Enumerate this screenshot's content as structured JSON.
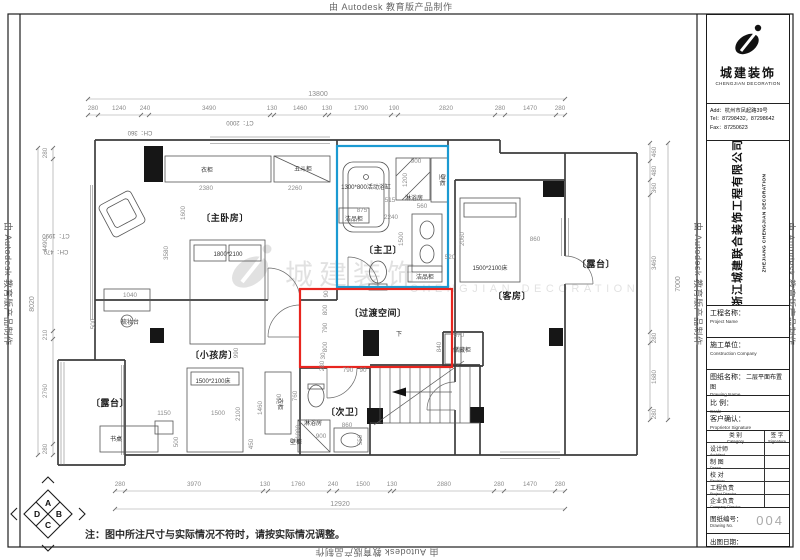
{
  "watermark": {
    "text": "由 Autodesk 教育版产品制作"
  },
  "watermark_center": {
    "cn": "城建装饰",
    "en": "CHENGJIAN DECORATION"
  },
  "note": "注：图中所注尺寸与实际情况不符时，请按实际情况调整。",
  "compass": {
    "a": "A",
    "b": "B",
    "c": "C",
    "d": "D"
  },
  "title_block": {
    "logo_text": "城建装饰",
    "logo_sub": "CHENGJIAN DECORATION",
    "address": "Add：杭州市凤起路39号",
    "tel": "Tel：87298432，87298642",
    "fax": "Fax：87250623",
    "company_cn": "浙江城建联合装饰工程有限公司",
    "company_en": "ZHEJIANG CHENGJIAN DECORATION",
    "fields": [
      {
        "cn": "工程名称：",
        "en": "Project Name",
        "value": ""
      },
      {
        "cn": "施工单位：",
        "en": "Construction Company",
        "value": ""
      },
      {
        "cn": "图纸名称：",
        "en": "Drawing Name",
        "value": "二层平面布置图"
      },
      {
        "cn": "比 例：",
        "en": "Scale",
        "value": ""
      },
      {
        "cn": "客户确认：",
        "en": "Proprietor Signature",
        "value": ""
      }
    ],
    "table": {
      "cat_cn": "类 别",
      "cat_en": "Category",
      "sig_cn": "签 字",
      "sig_en": "Signature",
      "rows": [
        {
          "cn": "设计师",
          "en": "Architect"
        },
        {
          "cn": "制 图",
          "en": "Drawn"
        },
        {
          "cn": "校 对",
          "en": "Revision"
        },
        {
          "cn": "工程负责",
          "en": "Project Director"
        },
        {
          "cn": "企业负责",
          "en": "Company Director"
        }
      ]
    },
    "drawing_no_cn": "图纸编号：",
    "drawing_no_en": "Drawing No.",
    "drawing_no": "004",
    "date_label": "出图日期："
  },
  "plan": {
    "labels": [
      {
        "t": "〔主卧房〕",
        "x": 225,
        "y": 221,
        "c": "room"
      },
      {
        "t": "〔主卫〕",
        "x": 383,
        "y": 253,
        "c": "room"
      },
      {
        "t": "〔过渡空间〕",
        "x": 378,
        "y": 316,
        "c": "room"
      },
      {
        "t": "〔客房〕",
        "x": 512,
        "y": 299,
        "c": "room"
      },
      {
        "t": "〔露台〕",
        "x": 596,
        "y": 267,
        "c": "room"
      },
      {
        "t": "〔露台〕",
        "x": 110,
        "y": 406,
        "c": "room"
      },
      {
        "t": "〔小孩房〕",
        "x": 214,
        "y": 358,
        "c": "room"
      },
      {
        "t": "〔次卫〕",
        "x": 345,
        "y": 415,
        "c": "room"
      },
      {
        "t": "衣柜",
        "x": 207,
        "y": 172,
        "c": "furn"
      },
      {
        "t": "五斗柜",
        "x": 303,
        "y": 171,
        "c": "furn"
      },
      {
        "t": "梳妆台",
        "x": 130,
        "y": 324,
        "c": "furn"
      },
      {
        "t": "1800*2100",
        "x": 228,
        "y": 256,
        "c": "furn"
      },
      {
        "t": "1300*800活动浴缸",
        "x": 366,
        "y": 189,
        "c": "furn"
      },
      {
        "t": "淋浴房",
        "x": 414,
        "y": 200,
        "c": "furn"
      },
      {
        "t": "洁品柜",
        "x": 354,
        "y": 221,
        "c": "furn"
      },
      {
        "t": "洁品柜",
        "x": 425,
        "y": 279,
        "c": "furn"
      },
      {
        "t": "壁柜",
        "x": 440,
        "y": 180,
        "r": 90,
        "c": "furn"
      },
      {
        "t": "1500*2100床",
        "x": 490,
        "y": 270,
        "c": "furn"
      },
      {
        "t": "储藏柜",
        "x": 462,
        "y": 352,
        "c": "furn"
      },
      {
        "t": "1500*2100床",
        "x": 213,
        "y": 383,
        "c": "furn"
      },
      {
        "t": "书桌",
        "x": 116,
        "y": 441,
        "c": "furn"
      },
      {
        "t": "衣柜",
        "x": 278,
        "y": 404,
        "r": 90,
        "c": "furn"
      },
      {
        "t": "淋浴房",
        "x": 313,
        "y": 425,
        "c": "furn"
      },
      {
        "t": "壁柜",
        "x": 296,
        "y": 444,
        "c": "furn"
      },
      {
        "t": "下",
        "x": 399,
        "y": 336,
        "c": "furn"
      },
      {
        "t": "CT：2000",
        "x": 240,
        "y": 121,
        "r": 180,
        "c": "ann"
      },
      {
        "t": "CH：360",
        "x": 140,
        "y": 131,
        "r": 180,
        "c": "ann"
      },
      {
        "t": "CT：1990",
        "x": 56,
        "y": 234,
        "r": 180,
        "c": "ann"
      },
      {
        "t": "CH：470",
        "x": 56,
        "y": 250,
        "r": 180,
        "c": "ann"
      },
      {
        "t": "13800",
        "x": 318,
        "y": 96,
        "c": "tot"
      },
      {
        "t": "12920",
        "x": 340,
        "y": 506,
        "c": "tot"
      },
      {
        "t": "8020",
        "x": 34,
        "y": 304,
        "r": -90,
        "c": "tot"
      },
      {
        "t": "7000",
        "x": 680,
        "y": 284,
        "r": -90,
        "c": "tot"
      },
      {
        "t": "280",
        "x": 93,
        "y": 110
      },
      {
        "t": "1240",
        "x": 119,
        "y": 110
      },
      {
        "t": "240",
        "x": 145,
        "y": 110
      },
      {
        "t": "3490",
        "x": 209,
        "y": 110
      },
      {
        "t": "130",
        "x": 272,
        "y": 110
      },
      {
        "t": "1460",
        "x": 300,
        "y": 110
      },
      {
        "t": "130",
        "x": 327,
        "y": 110
      },
      {
        "t": "1790",
        "x": 361,
        "y": 110
      },
      {
        "t": "190",
        "x": 394,
        "y": 110
      },
      {
        "t": "2820",
        "x": 446,
        "y": 110
      },
      {
        "t": "280",
        "x": 500,
        "y": 110
      },
      {
        "t": "1470",
        "x": 530,
        "y": 110
      },
      {
        "t": "280",
        "x": 560,
        "y": 110
      },
      {
        "t": "280",
        "x": 120,
        "y": 486
      },
      {
        "t": "3970",
        "x": 194,
        "y": 486
      },
      {
        "t": "130",
        "x": 265,
        "y": 486
      },
      {
        "t": "1760",
        "x": 298,
        "y": 486
      },
      {
        "t": "240",
        "x": 333,
        "y": 486
      },
      {
        "t": "1500",
        "x": 363,
        "y": 486
      },
      {
        "t": "130",
        "x": 392,
        "y": 486
      },
      {
        "t": "2880",
        "x": 444,
        "y": 486
      },
      {
        "t": "280",
        "x": 499,
        "y": 486
      },
      {
        "t": "1470",
        "x": 530,
        "y": 486
      },
      {
        "t": "280",
        "x": 560,
        "y": 486
      },
      {
        "t": "280",
        "x": 47,
        "y": 153,
        "r": -90
      },
      {
        "t": "4490",
        "x": 47,
        "y": 245,
        "r": -90
      },
      {
        "t": "210",
        "x": 47,
        "y": 335,
        "r": -90
      },
      {
        "t": "2760",
        "x": 47,
        "y": 391,
        "r": -90
      },
      {
        "t": "280",
        "x": 47,
        "y": 449,
        "r": -90
      },
      {
        "t": "460",
        "x": 656,
        "y": 152,
        "r": -90
      },
      {
        "t": "480",
        "x": 656,
        "y": 171,
        "r": -90
      },
      {
        "t": "360",
        "x": 656,
        "y": 188,
        "r": -90
      },
      {
        "t": "3460",
        "x": 656,
        "y": 263,
        "r": -90
      },
      {
        "t": "280",
        "x": 656,
        "y": 338,
        "r": -90
      },
      {
        "t": "1680",
        "x": 656,
        "y": 377,
        "r": -90
      },
      {
        "t": "280",
        "x": 656,
        "y": 414,
        "r": -90
      },
      {
        "t": "2380",
        "x": 206,
        "y": 190
      },
      {
        "t": "2260",
        "x": 295,
        "y": 190
      },
      {
        "t": "1600",
        "x": 185,
        "y": 213,
        "r": -90
      },
      {
        "t": "3580",
        "x": 168,
        "y": 253,
        "r": -90
      },
      {
        "t": "1040",
        "x": 130,
        "y": 297
      },
      {
        "t": "500",
        "x": 95,
        "y": 324,
        "r": -90
      },
      {
        "t": "900",
        "x": 416,
        "y": 163
      },
      {
        "t": "1200",
        "x": 407,
        "y": 180,
        "r": -90
      },
      {
        "t": "515",
        "x": 390,
        "y": 202
      },
      {
        "t": "875",
        "x": 362,
        "y": 212
      },
      {
        "t": "2240",
        "x": 391,
        "y": 219
      },
      {
        "t": "560",
        "x": 422,
        "y": 208
      },
      {
        "t": "1500",
        "x": 403,
        "y": 239,
        "r": -90
      },
      {
        "t": "520",
        "x": 450,
        "y": 259
      },
      {
        "t": "2060",
        "x": 464,
        "y": 239,
        "r": -90
      },
      {
        "t": "860",
        "x": 535,
        "y": 241
      },
      {
        "t": "870",
        "x": 459,
        "y": 337
      },
      {
        "t": "840",
        "x": 441,
        "y": 347,
        "r": -90
      },
      {
        "t": "90",
        "x": 328,
        "y": 294,
        "r": -90
      },
      {
        "t": "800",
        "x": 327,
        "y": 310,
        "r": -90
      },
      {
        "t": "790",
        "x": 327,
        "y": 328,
        "r": -90
      },
      {
        "t": "800",
        "x": 327,
        "y": 347,
        "r": -90
      },
      {
        "t": "30",
        "x": 325,
        "y": 356,
        "r": -90
      },
      {
        "t": "280",
        "x": 324,
        "y": 366,
        "r": -90
      },
      {
        "t": "790",
        "x": 348,
        "y": 372
      },
      {
        "t": "90",
        "x": 363,
        "y": 372
      },
      {
        "t": "990",
        "x": 238,
        "y": 353,
        "r": -90
      },
      {
        "t": "1150",
        "x": 164,
        "y": 415
      },
      {
        "t": "1500",
        "x": 218,
        "y": 415
      },
      {
        "t": "2100",
        "x": 240,
        "y": 414,
        "r": -90
      },
      {
        "t": "1460",
        "x": 262,
        "y": 408,
        "r": -90
      },
      {
        "t": "450",
        "x": 253,
        "y": 444,
        "r": -90
      },
      {
        "t": "500",
        "x": 178,
        "y": 442,
        "r": -90
      },
      {
        "t": "790",
        "x": 281,
        "y": 399,
        "r": -90
      },
      {
        "t": "1000",
        "x": 300,
        "y": 432,
        "r": -90
      },
      {
        "t": "760",
        "x": 297,
        "y": 396,
        "r": -90
      },
      {
        "t": "900",
        "x": 321,
        "y": 438
      },
      {
        "t": "860",
        "x": 347,
        "y": 427
      },
      {
        "t": "550",
        "x": 362,
        "y": 440,
        "r": -90
      }
    ]
  }
}
